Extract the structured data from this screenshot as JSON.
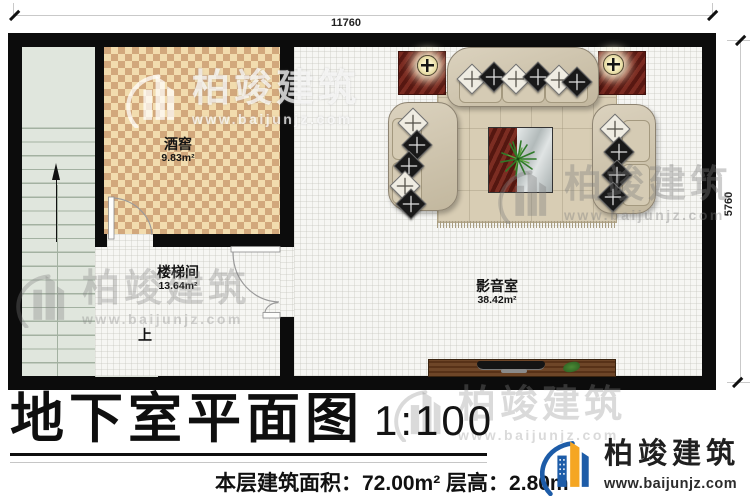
{
  "plan": {
    "dim_top": "11760",
    "dim_right": "5760",
    "rooms": [
      {
        "name": "酒窖",
        "area": "9.83m²"
      },
      {
        "name": "楼梯间",
        "area": "13.64m²"
      },
      {
        "name": "影音室",
        "area": "38.42m²"
      }
    ],
    "stairs_up": "上"
  },
  "title": {
    "main": "地下室平面图",
    "scale": "1:100"
  },
  "footer": {
    "stats": "本层建筑面积：72.00m² 层高：2.80m"
  },
  "brand": {
    "name": "柏竣建筑",
    "url": "www.baijunjz.com"
  },
  "watermark": {
    "text": "柏竣建筑",
    "url": "www.baijunjz.com"
  },
  "colors": {
    "wall": "#0c0c0c",
    "wine_floor_light": "#f2dcae",
    "wine_floor_dark": "#d2a87c",
    "stairs": "#e0e6dd",
    "mat_red": "#6e221a",
    "sofa": "#cfc5ae",
    "rug": "#d8cdb4",
    "logo_blue": "#1d5ca8",
    "logo_orange": "#f5a623"
  }
}
